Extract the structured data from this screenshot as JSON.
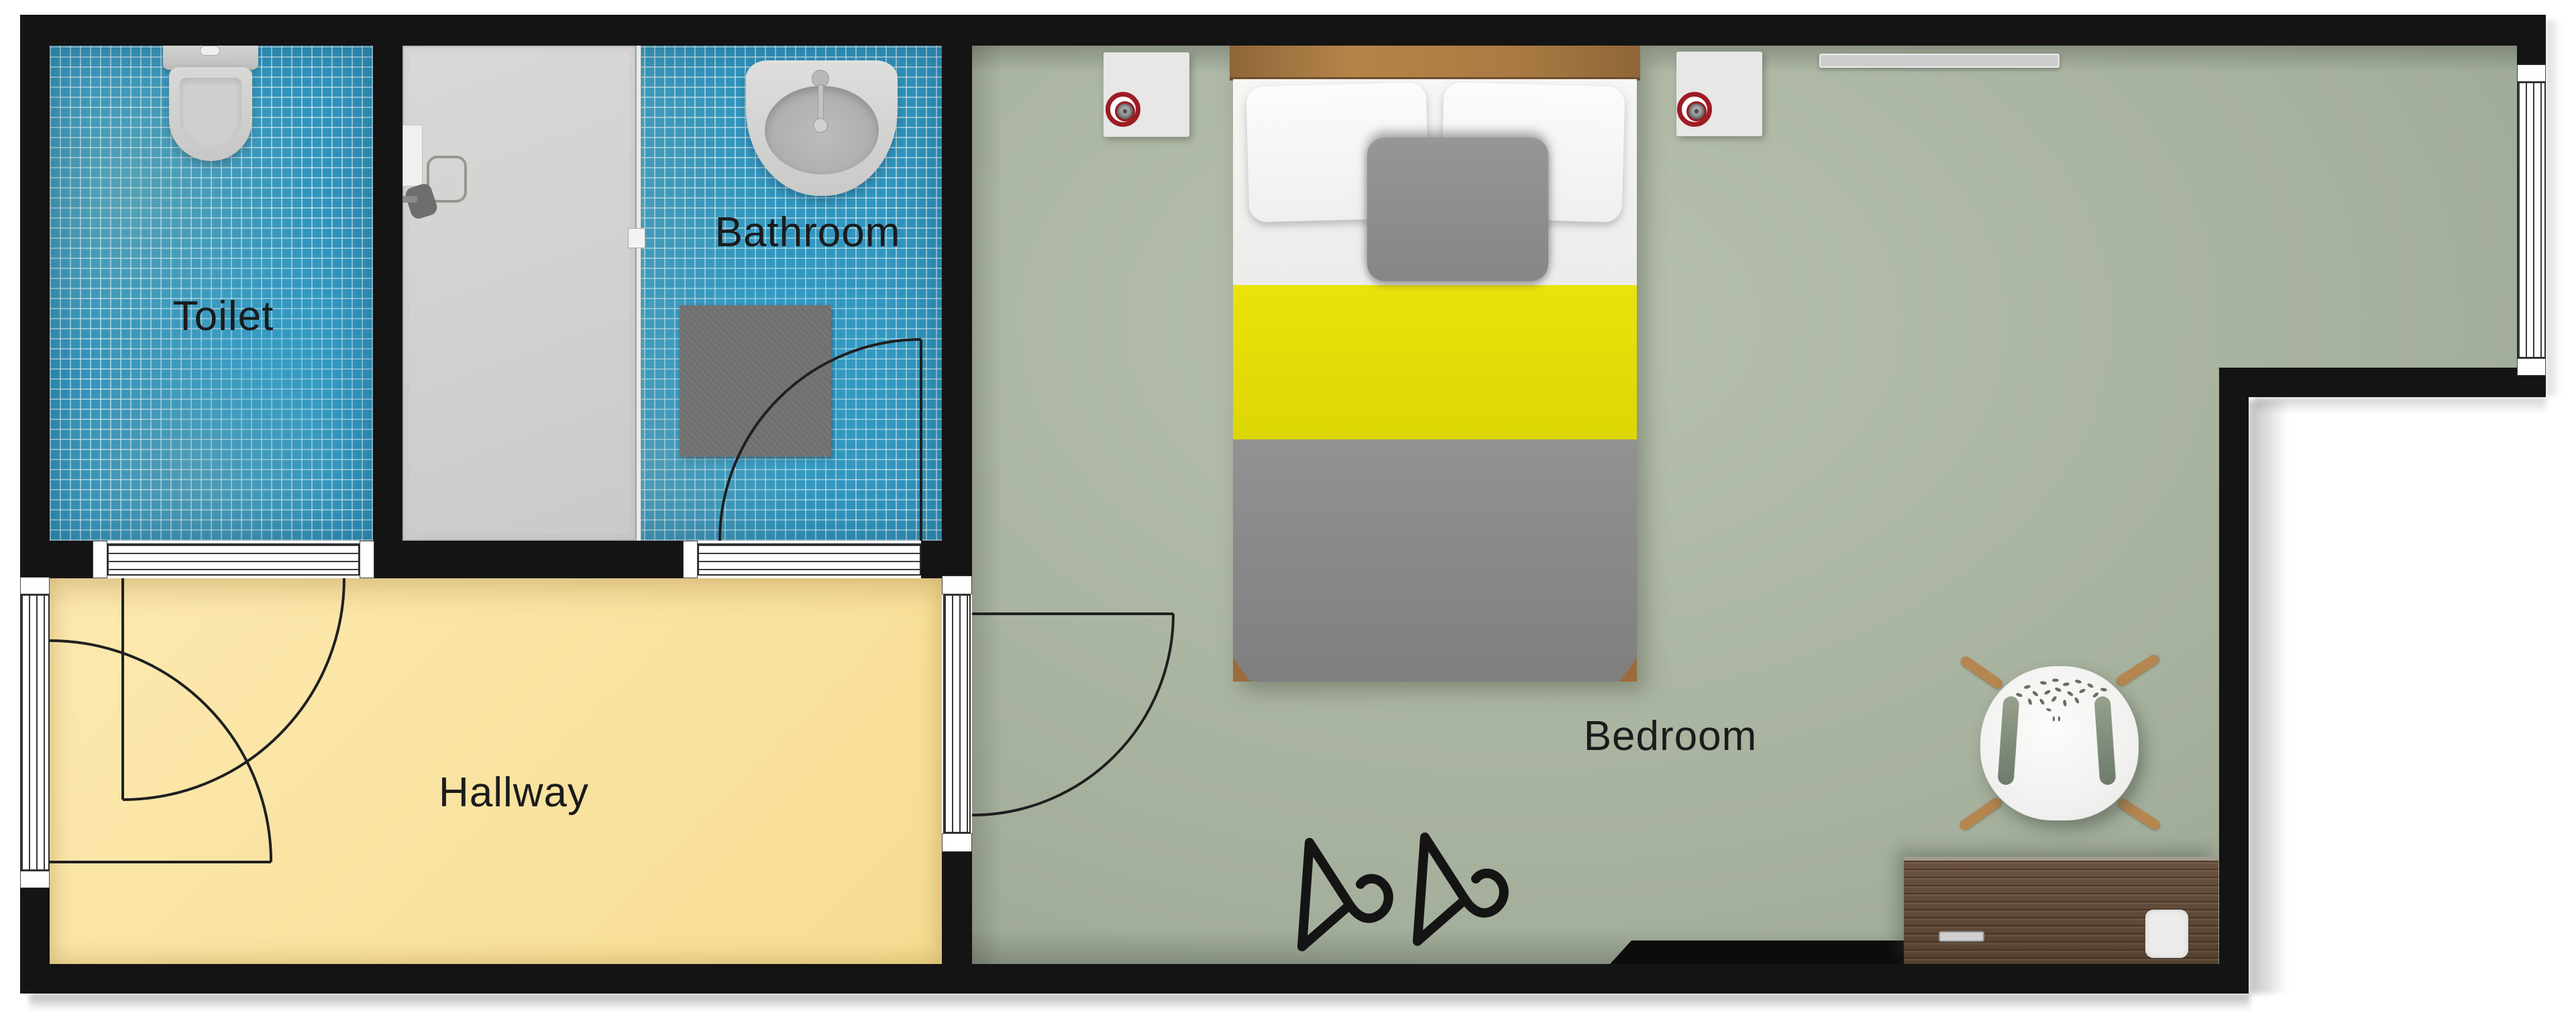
{
  "rooms": {
    "toilet": {
      "label": "Toilet"
    },
    "bathroom": {
      "label": "Bathroom"
    },
    "hallway": {
      "label": "Hallway"
    },
    "bedroom": {
      "label": "Bedroom"
    }
  },
  "palette": {
    "wall_black": "#141414",
    "tile_blue": "#3094bd",
    "hallway_yellow": "#f8e19c",
    "bedroom_green": "#a9b4a1",
    "bed_accent_yellow": "#e6de06",
    "bed_blanket_gray": "#8d8d8d",
    "headboard_wood": "#a87a44",
    "desk_wood": "#5b4334",
    "chair_leg_wood": "#b5864f",
    "lamp_highlight_red": "#9e1b24"
  },
  "furniture_icons": [
    "toilet-icon",
    "shower-icon",
    "shower-glass-icon",
    "sink-icon",
    "bath-mat-icon",
    "double-bed-icon",
    "pillow-icon",
    "cushion-icon",
    "nightstand-icon",
    "lamp-icon",
    "red-circle-highlight-icon",
    "radiator-icon",
    "tv-panel-icon",
    "clothes-hanger-icon",
    "desk-icon",
    "desk-handle-icon",
    "paper-icon",
    "chair-icon",
    "door-swing-icon",
    "window-icon"
  ]
}
